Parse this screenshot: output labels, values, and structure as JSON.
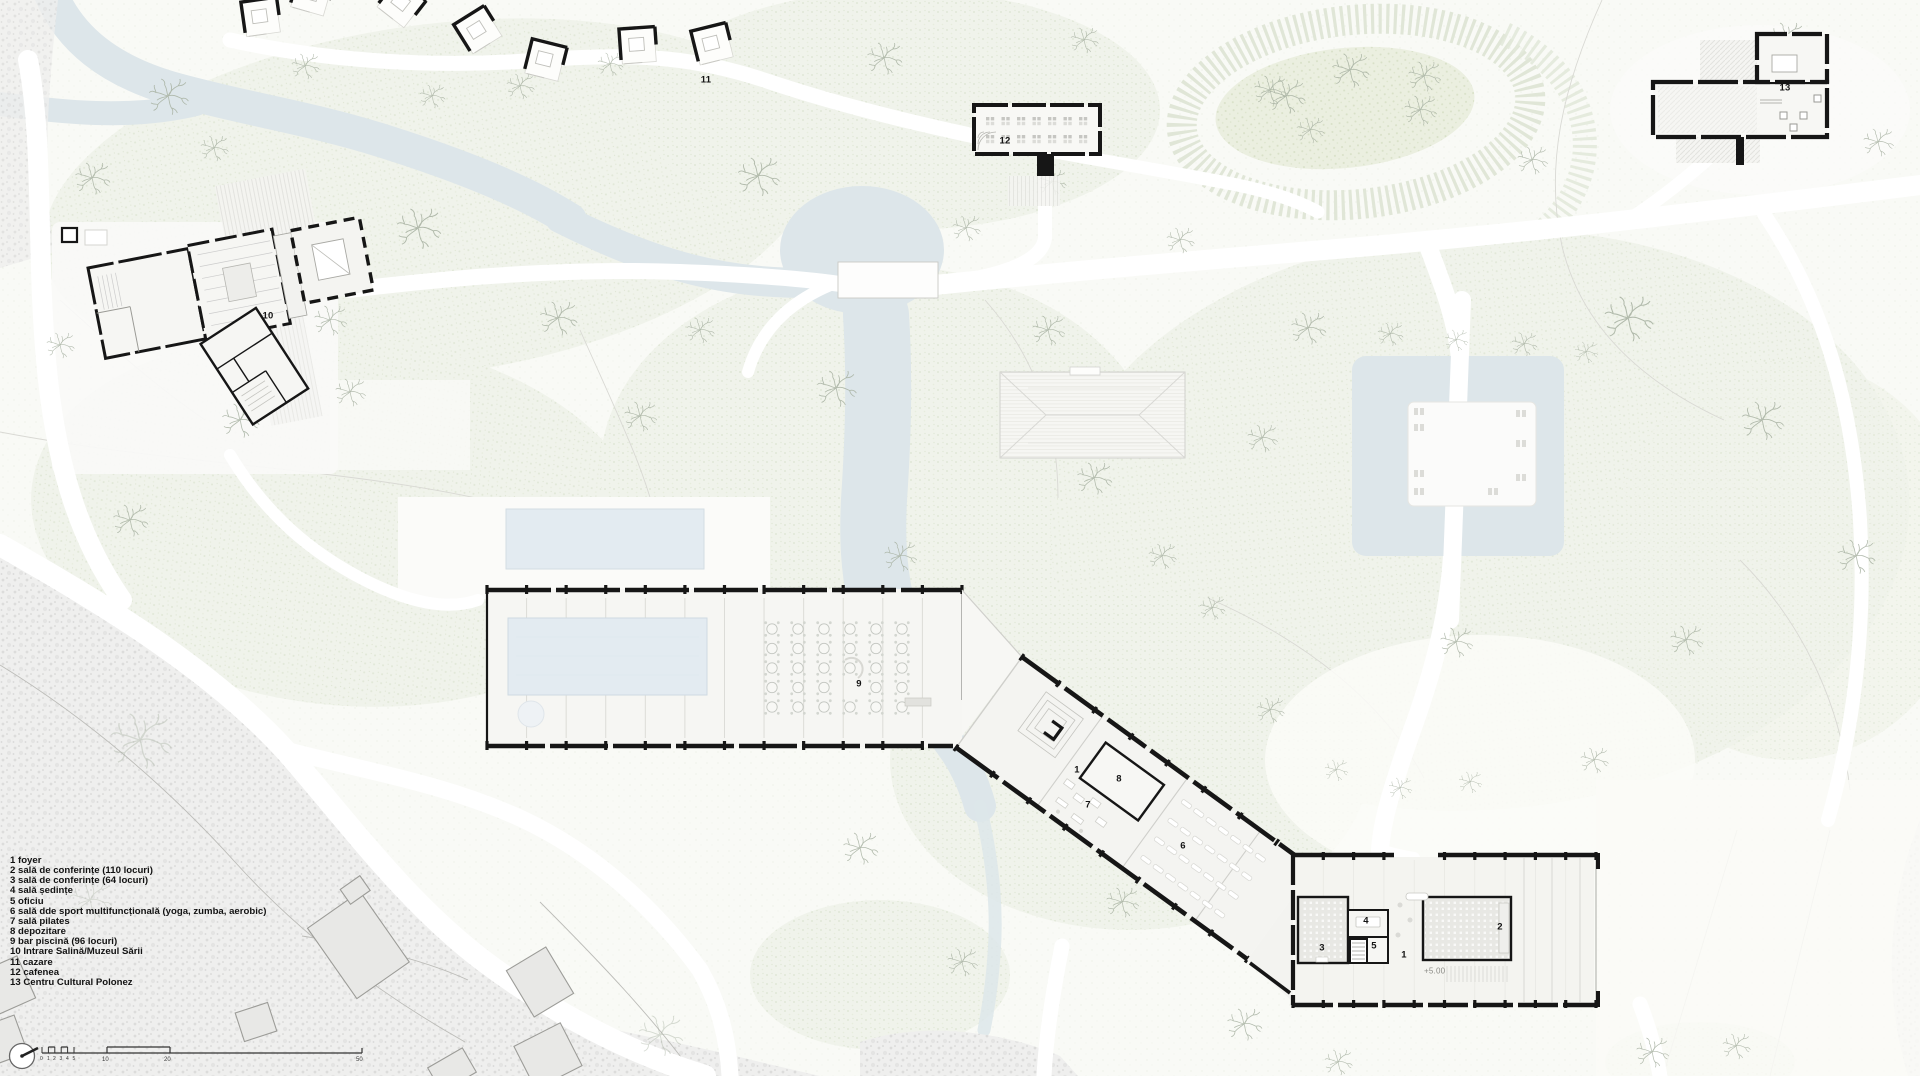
{
  "legend": {
    "items": [
      "1 foyer",
      "2 sală de conferințe (110 locuri)",
      "3 sală de conferințe (64 locuri)",
      "4 sală ședințe",
      "5 oficiu",
      "6 sală dde sport multifuncțională (yoga, zumba, aerobic)",
      "7 sală pilates",
      "8 depozitare",
      "9 bar piscină (96 locuri)",
      "10 Intrare Salină/Muzeul Sării",
      "11 cazare",
      "12 cafenea",
      "13 Centru Cultural Polonez"
    ]
  },
  "plan_labels": {
    "cafenea": "12",
    "cultural_center": "13",
    "salina_entrance": "10",
    "cazare": "11",
    "pool_bar": "9",
    "foyer_upper": "1",
    "pilates": "7",
    "depozitare": "8",
    "sport_hall": "6",
    "conf_64": "3",
    "sedinte": "4",
    "oficiu": "5",
    "foyer_lower": "1",
    "conf_110": "2",
    "elevation": "+5.00"
  },
  "scale_bar": {
    "ticks": [
      "0",
      "1",
      "2",
      "3",
      "4",
      "5",
      "10",
      "20",
      "50"
    ]
  },
  "colors": {
    "river": "#dde6ea",
    "pool": "#e3ebf1",
    "wall": "#161616",
    "park_dot": "#dfe6d4",
    "gravel_dot": "#d9d9d7"
  }
}
